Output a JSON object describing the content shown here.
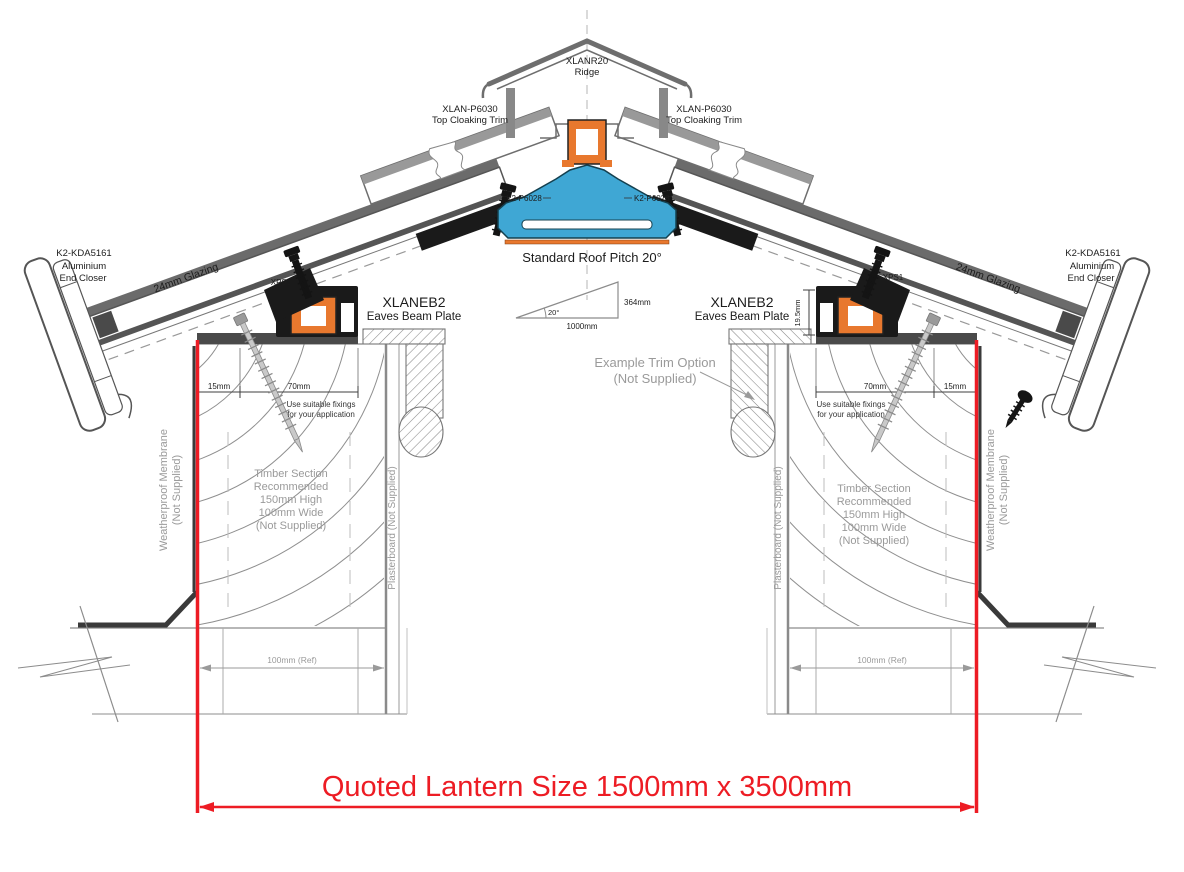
{
  "drawing": {
    "ridge": {
      "part": "XLANR20",
      "name": "Ridge"
    },
    "top_cloaking": {
      "part": "XLAN-P6030",
      "name": "Top Cloaking Trim"
    },
    "ridge_bolt_part": "K2-P6028",
    "roof_pitch": {
      "title": "Standard Roof Pitch 20°",
      "angle": "20°",
      "base": "1000mm",
      "rise": "364mm"
    },
    "end_closer": {
      "part": "K2-KDA5161",
      "line2": "Aluminium",
      "line3": "End Closer"
    },
    "glazing_label": "24mm Glazing",
    "gasket_part": "XPS1",
    "eaves_beam": {
      "part": "XLANEB2",
      "name": "Eaves Beam Plate"
    },
    "beam_upstand_dim": "19.5mm",
    "dim_15": "15mm",
    "dim_70": "70mm",
    "dim_100_ref": "100mm (Ref)",
    "fixings_note": {
      "line1": "Use suitable fixings",
      "line2": "for your application"
    },
    "timber_note": {
      "line1": "Timber Section",
      "line2": "Recommended",
      "line3": "150mm High",
      "line4": "100mm Wide",
      "line5": "(Not Supplied)"
    },
    "membrane": {
      "line1": "Weatherproof Membrane",
      "line2": "(Not Supplied)"
    },
    "plasterboard": "Plasterboard (Not Supplied)",
    "trim_option": {
      "line1": "Example  Trim Option",
      "line2": "(Not Supplied)"
    },
    "quoted_size": "Quoted Lantern Size 1500mm x 3500mm",
    "colors": {
      "accent_red": "#ed1c24",
      "profile_orange": "#e8782e",
      "profile_blue": "#3fa7d4",
      "linework_gray": "#6e6e6e",
      "note_gray": "#9a9a9a"
    }
  }
}
